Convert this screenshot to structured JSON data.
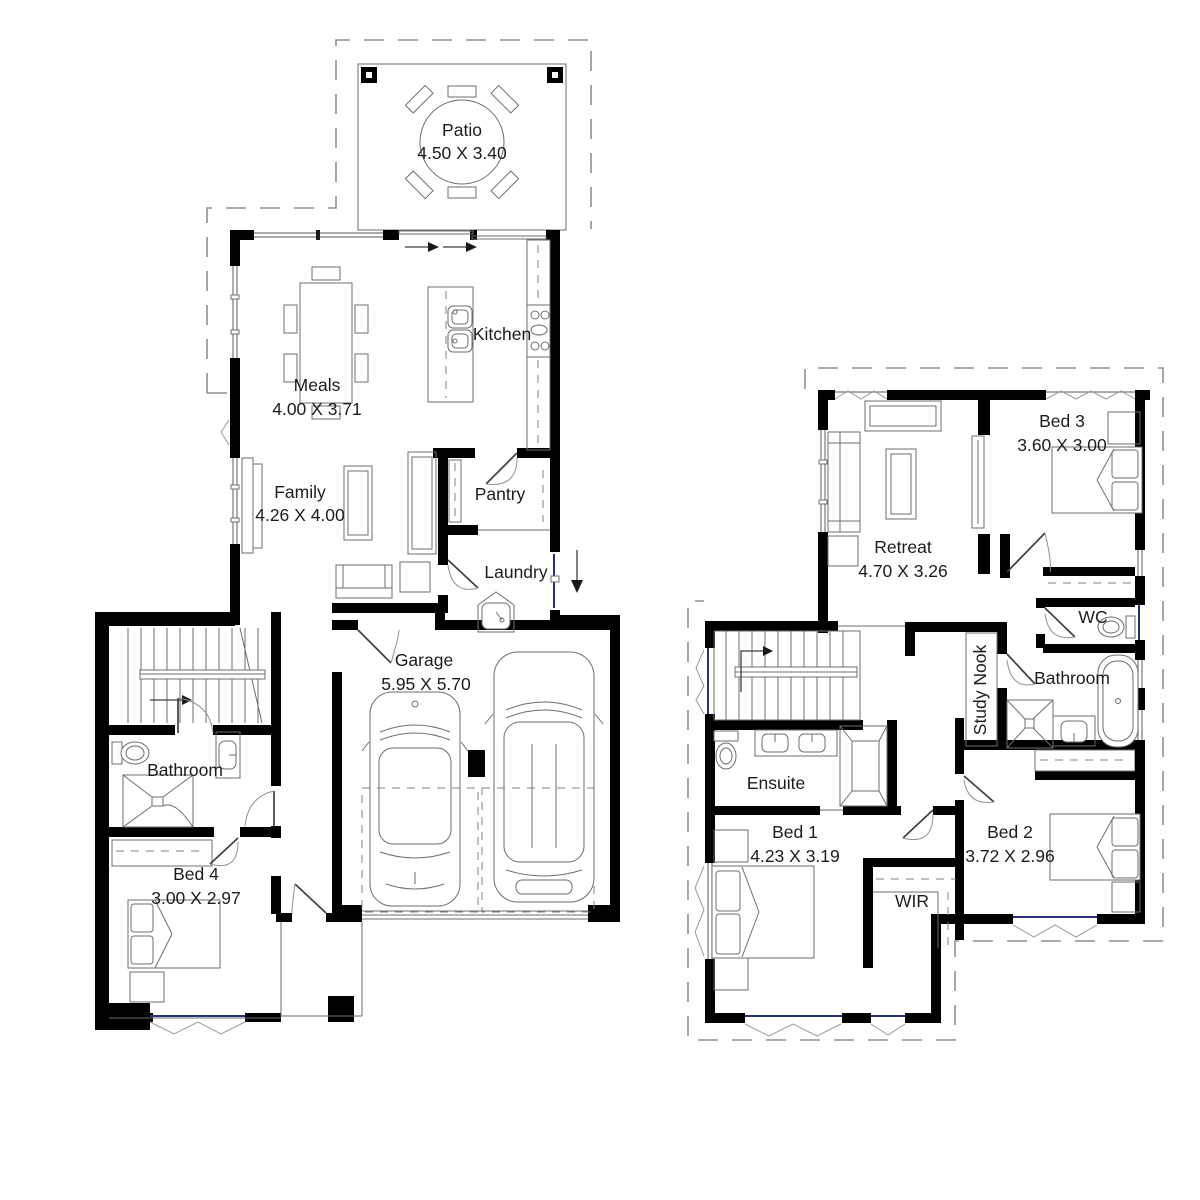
{
  "colors": {
    "wall": "#000000",
    "furniture_line": "#6e6e6e",
    "window_accent": "#27317e",
    "dashed_boundary": "#8f8f8f",
    "label_text": "#1c1c1c",
    "background": "#ffffff"
  },
  "ground_floor": {
    "patio": {
      "name": "Patio",
      "dims": "4.50 X 3.40"
    },
    "meals": {
      "name": "Meals",
      "dims": "4.00 X 3.71"
    },
    "kitchen": {
      "name": "Kitchen"
    },
    "family": {
      "name": "Family",
      "dims": "4.26 X 4.00"
    },
    "pantry": {
      "name": "Pantry"
    },
    "laundry": {
      "name": "Laundry"
    },
    "garage": {
      "name": "Garage",
      "dims": "5.95 X 5.70"
    },
    "bathroom": {
      "name": "Bathroom"
    },
    "bed4": {
      "name": "Bed 4",
      "dims": "3.00 X 2.97"
    }
  },
  "first_floor": {
    "retreat": {
      "name": "Retreat",
      "dims": "4.70 X 3.26"
    },
    "bed3": {
      "name": "Bed 3",
      "dims": "3.60 X 3.00"
    },
    "wc": {
      "name": "WC"
    },
    "bathroom": {
      "name": "Bathroom"
    },
    "study_nook": {
      "name": "Study Nook"
    },
    "ensuite": {
      "name": "Ensuite"
    },
    "bed1": {
      "name": "Bed 1",
      "dims": "4.23 X 3.19"
    },
    "bed2": {
      "name": "Bed 2",
      "dims": "3.72 X 2.96"
    },
    "wir": {
      "name": "WIR"
    }
  }
}
